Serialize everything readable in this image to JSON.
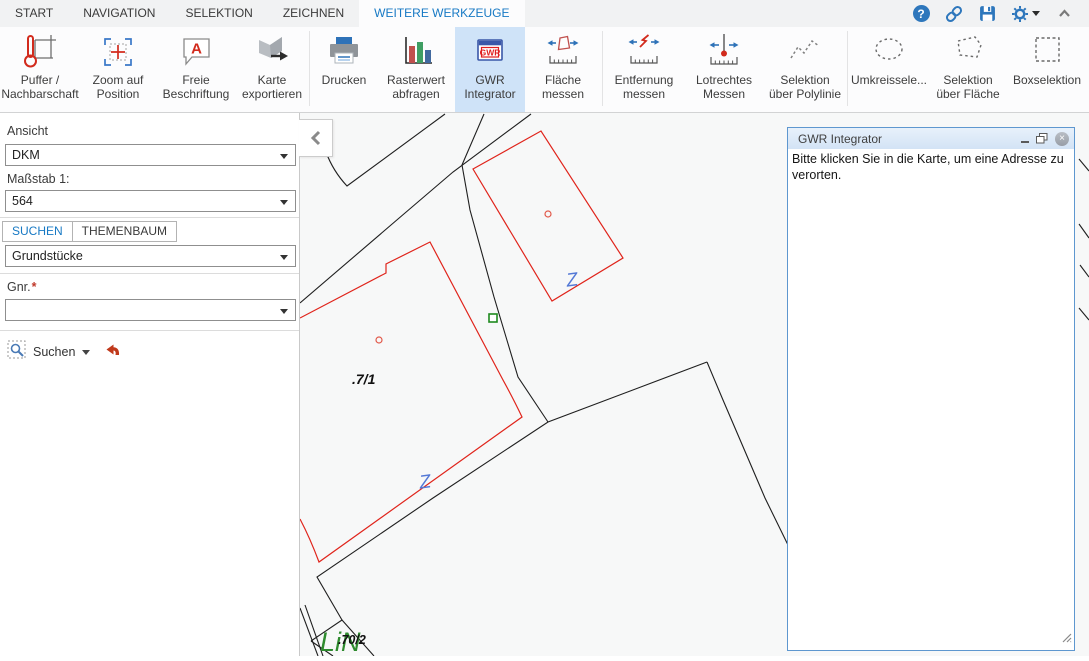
{
  "colors": {
    "accent_blue": "#1779c4",
    "selected_tool_bg": "#cfe3f8",
    "parcel_line_red": "#e0241b",
    "boundary_line_black": "#1f1f1f",
    "fence_symbol_blue": "#5479d6",
    "vegetation_green": "#2e8b2e",
    "panel_border_blue": "#5e97cf"
  },
  "menubar": {
    "tabs": [
      {
        "label": "START"
      },
      {
        "label": "NAVIGATION"
      },
      {
        "label": "SELEKTION"
      },
      {
        "label": "ZEICHNEN"
      },
      {
        "label": "WEITERE WERKZEUGE",
        "active": true
      }
    ],
    "icons": [
      "help-icon",
      "link-icon",
      "save-icon",
      "gear-icon",
      "collapse-ribbon-chevron"
    ]
  },
  "toolbar": {
    "buttons": [
      {
        "icon": "thermometer-parcel",
        "lines": [
          "Puffer /",
          "Nachbarschaft"
        ]
      },
      {
        "icon": "crosshair-position",
        "lines": [
          "Zoom auf",
          "Position"
        ]
      },
      {
        "icon": "label-bubble-a",
        "icon_text": "A",
        "lines": [
          "Freie",
          "Beschriftung"
        ]
      },
      {
        "icon": "map-export-arrow",
        "lines": [
          "Karte",
          "exportieren"
        ]
      },
      {
        "icon": "printer",
        "lines": [
          "Drucken"
        ]
      },
      {
        "icon": "bar-chart",
        "lines": [
          "Rasterwert",
          "abfragen"
        ]
      },
      {
        "icon": "gwr-window",
        "icon_text": "GWR",
        "lines": [
          "GWR",
          "Integrator"
        ],
        "selected": true
      },
      {
        "icon": "area-measure",
        "lines": [
          "Fläche",
          "messen"
        ]
      },
      {
        "icon": "distance-measure",
        "lines": [
          "Entfernung",
          "messen"
        ]
      },
      {
        "icon": "perpendicular-measure",
        "lines": [
          "Lotrechtes",
          "Messen"
        ]
      },
      {
        "icon": "polyline-select",
        "lines": [
          "Selektion",
          "über Polylinie"
        ]
      },
      {
        "icon": "circle-select",
        "lines": [
          "Umkreissele..."
        ]
      },
      {
        "icon": "polygon-select",
        "lines": [
          "Selektion",
          "über Fläche"
        ]
      },
      {
        "icon": "box-select",
        "lines": [
          "Boxselektion"
        ]
      }
    ]
  },
  "sidebar": {
    "ansicht_label": "Ansicht",
    "ansicht_value": "DKM",
    "massstab_label": "Maßstab 1:",
    "massstab_value": "564",
    "tabs": [
      {
        "label": "SUCHEN",
        "active": true
      },
      {
        "label": "THEMENBAUM"
      }
    ],
    "layer_value": "Grundstücke",
    "gnr_label": "Gnr.",
    "required_marker": "*",
    "gnr_value": "",
    "search_button_label": "Suchen",
    "icons": [
      "selection-magnifier-icon",
      "undo-arrow-icon"
    ]
  },
  "map": {
    "parcel_label_1": ".7/1",
    "parcel_label_2": ".70/2",
    "green_label": "LiN",
    "fence_symbol": "Z"
  },
  "panel": {
    "title": "GWR Integrator",
    "message": "Bitte klicken Sie in die Karte, um eine Adresse zu verorten.",
    "window_icons": [
      "minimize-icon",
      "restore-icon",
      "close-icon",
      "resize-grip"
    ]
  }
}
